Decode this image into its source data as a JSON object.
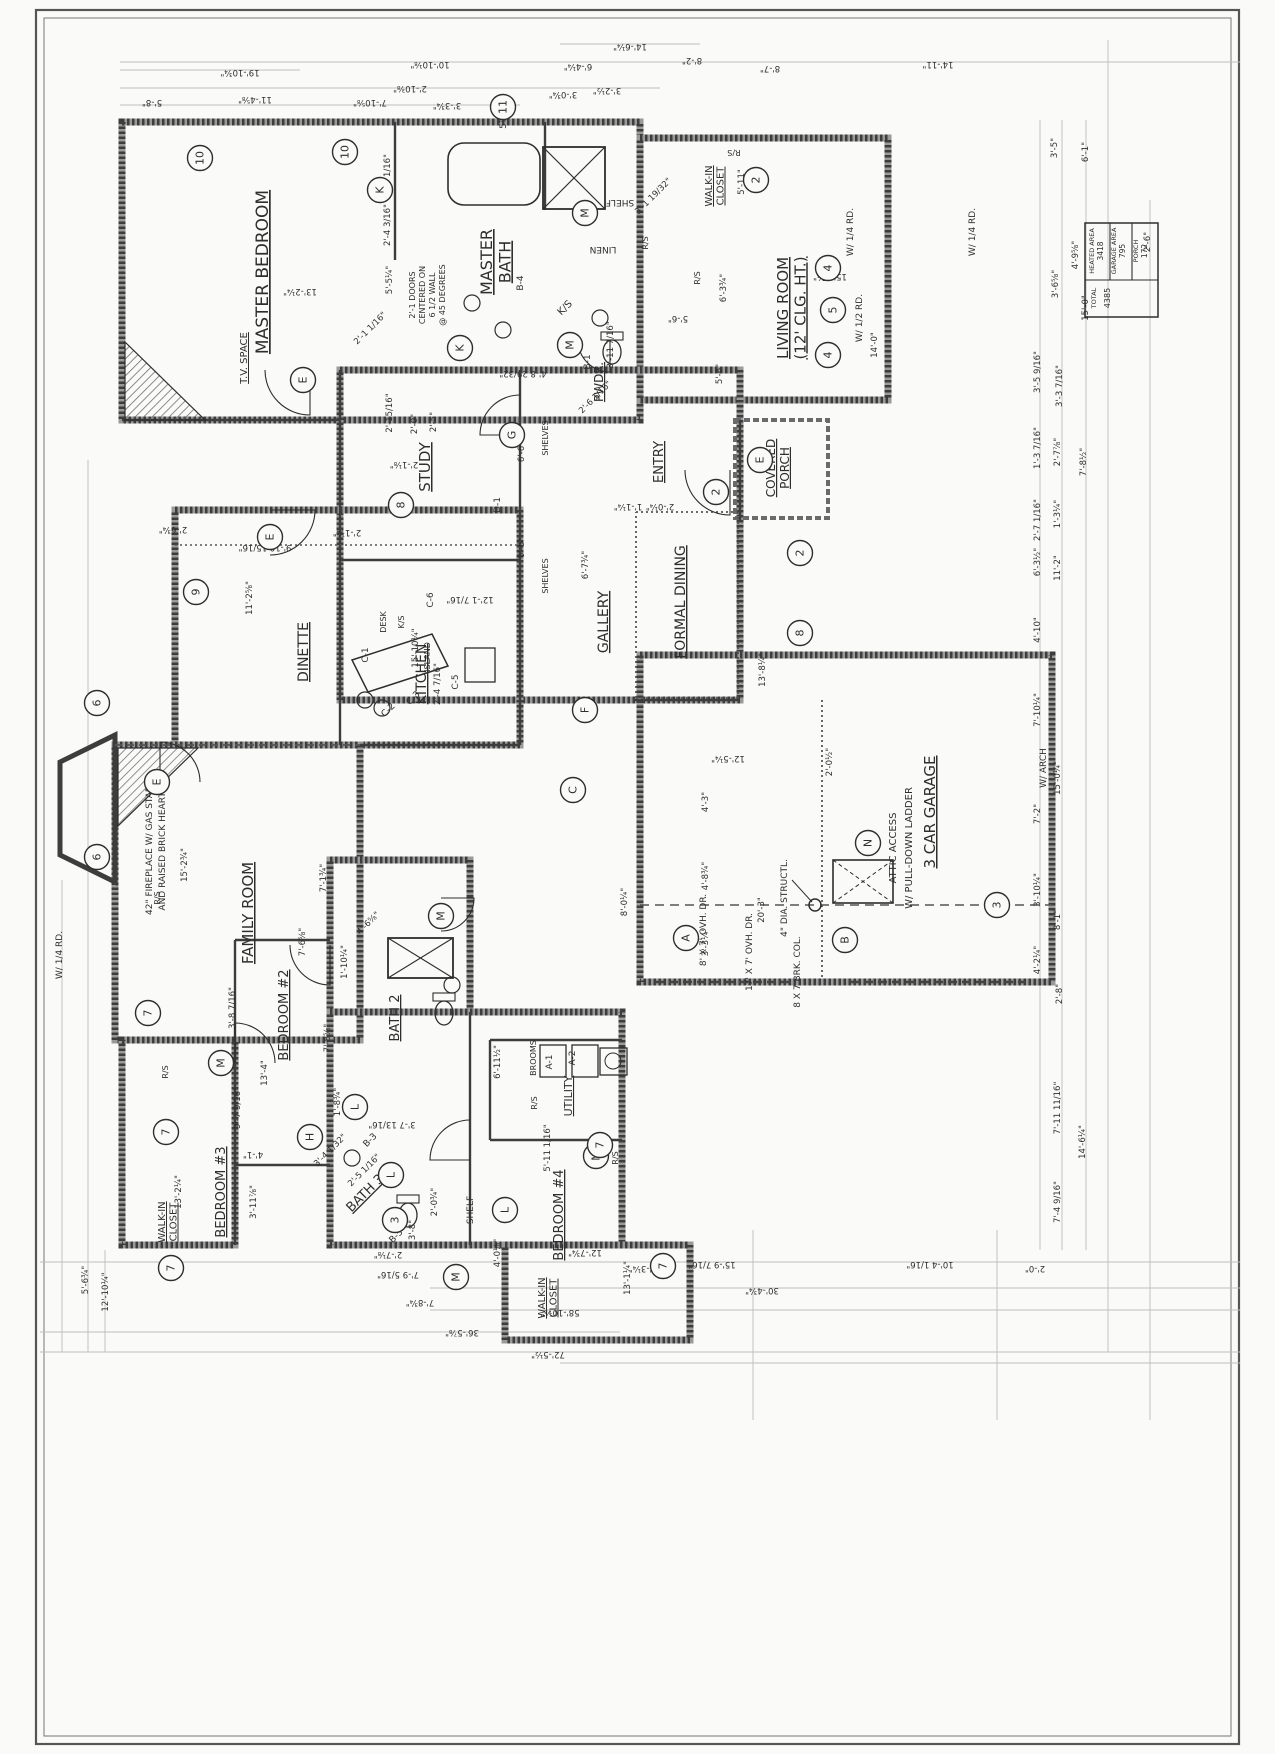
{
  "sheet": {
    "type": "residential floor plan (scanned blueprint, drawing rotated 90°)"
  },
  "area_table": {
    "cells": [
      {
        "label": "HEATED AREA",
        "value": "3418"
      },
      {
        "label": "GARAGE AREA",
        "value": "795"
      },
      {
        "label": "PORCH",
        "value": "172"
      }
    ],
    "total": {
      "label": "TOTAL",
      "value": "4385"
    }
  },
  "rooms": [
    {
      "label": [
        "MASTER BEDROOM"
      ],
      "x": 268,
      "y": 272,
      "s": 17
    },
    {
      "label": [
        "MASTER",
        "BATH"
      ],
      "x": 492,
      "y": 262,
      "s": 16
    },
    {
      "label": [
        "LIVING ROOM",
        "(12' CLG. HT.)"
      ],
      "x": 788,
      "y": 308,
      "s": 15
    },
    {
      "label": [
        "WALK-IN",
        "CLOSET"
      ],
      "x": 712,
      "y": 186,
      "s": 10
    },
    {
      "label": [
        "PWDR."
      ],
      "x": 603,
      "y": 382,
      "s": 12
    },
    {
      "label": [
        "ENTRY"
      ],
      "x": 663,
      "y": 462,
      "s": 13
    },
    {
      "label": [
        "STUDY"
      ],
      "x": 430,
      "y": 467,
      "s": 15
    },
    {
      "label": [
        "GALLERY"
      ],
      "x": 608,
      "y": 622,
      "s": 14
    },
    {
      "label": [
        "FORMAL DINING"
      ],
      "x": 685,
      "y": 602,
      "s": 14
    },
    {
      "label": [
        "DINETTE"
      ],
      "x": 308,
      "y": 652,
      "s": 14
    },
    {
      "label": [
        "KITCHEN"
      ],
      "x": 426,
      "y": 674,
      "s": 14
    },
    {
      "label": [
        "FAMILY ROOM"
      ],
      "x": 253,
      "y": 913,
      "s": 15
    },
    {
      "label": [
        "BATH 2"
      ],
      "x": 399,
      "y": 1018,
      "s": 13
    },
    {
      "label": [
        "BEDROOM #2"
      ],
      "x": 288,
      "y": 1015,
      "s": 13
    },
    {
      "label": [
        "BEDROOM #3"
      ],
      "x": 225,
      "y": 1192,
      "s": 13
    },
    {
      "label": [
        "BATH 3"
      ],
      "x": 368,
      "y": 1196,
      "s": 13,
      "r": -45
    },
    {
      "label": [
        "BEDROOM #4"
      ],
      "x": 563,
      "y": 1215,
      "s": 13
    },
    {
      "label": [
        "UTILITY"
      ],
      "x": 572,
      "y": 1096,
      "s": 11
    },
    {
      "label": [
        "3 CAR GARAGE"
      ],
      "x": 935,
      "y": 812,
      "s": 15
    },
    {
      "label": [
        "COVERED",
        "PORCH"
      ],
      "x": 775,
      "y": 468,
      "s": 12
    },
    {
      "label": [
        "WALK-IN",
        "CLOSET"
      ],
      "x": 165,
      "y": 1222,
      "s": 10
    },
    {
      "label": [
        "WALK-IN",
        "CLOSET"
      ],
      "x": 545,
      "y": 1298,
      "s": 10
    },
    {
      "label": [
        "T.V. SPACE"
      ],
      "x": 247,
      "y": 358,
      "s": 10
    }
  ],
  "markers": [
    {
      "t": "10",
      "x": 200,
      "y": 158
    },
    {
      "t": "10",
      "x": 345,
      "y": 152
    },
    {
      "t": "11",
      "x": 503,
      "y": 107
    },
    {
      "t": "K",
      "x": 380,
      "y": 190
    },
    {
      "t": "K",
      "x": 460,
      "y": 348
    },
    {
      "t": "E",
      "x": 303,
      "y": 380
    },
    {
      "t": "E",
      "x": 270,
      "y": 537
    },
    {
      "t": "E",
      "x": 760,
      "y": 460
    },
    {
      "t": "E",
      "x": 157,
      "y": 782
    },
    {
      "t": "M",
      "x": 585,
      "y": 213
    },
    {
      "t": "M",
      "x": 570,
      "y": 345
    },
    {
      "t": "M",
      "x": 441,
      "y": 916
    },
    {
      "t": "M",
      "x": 221,
      "y": 1063
    },
    {
      "t": "M",
      "x": 596,
      "y": 1156
    },
    {
      "t": "M",
      "x": 456,
      "y": 1277
    },
    {
      "t": "G",
      "x": 512,
      "y": 435
    },
    {
      "t": "8",
      "x": 401,
      "y": 505
    },
    {
      "t": "8",
      "x": 800,
      "y": 633
    },
    {
      "t": "2",
      "x": 756,
      "y": 180
    },
    {
      "t": "2",
      "x": 800,
      "y": 553
    },
    {
      "t": "2",
      "x": 716,
      "y": 492
    },
    {
      "t": "9",
      "x": 196,
      "y": 592
    },
    {
      "t": "4",
      "x": 828,
      "y": 268
    },
    {
      "t": "4",
      "x": 828,
      "y": 355
    },
    {
      "t": "5",
      "x": 833,
      "y": 310
    },
    {
      "t": "6",
      "x": 97,
      "y": 703
    },
    {
      "t": "6",
      "x": 97,
      "y": 857
    },
    {
      "t": "7",
      "x": 148,
      "y": 1013
    },
    {
      "t": "7",
      "x": 166,
      "y": 1132
    },
    {
      "t": "7",
      "x": 171,
      "y": 1268
    },
    {
      "t": "7",
      "x": 600,
      "y": 1145
    },
    {
      "t": "7",
      "x": 663,
      "y": 1266
    },
    {
      "t": "3",
      "x": 997,
      "y": 905
    },
    {
      "t": "3",
      "x": 395,
      "y": 1220
    },
    {
      "t": "N",
      "x": 868,
      "y": 843
    },
    {
      "t": "F",
      "x": 585,
      "y": 710
    },
    {
      "t": "C",
      "x": 573,
      "y": 790
    },
    {
      "t": "A",
      "x": 686,
      "y": 938
    },
    {
      "t": "B",
      "x": 845,
      "y": 940
    },
    {
      "t": "H",
      "x": 310,
      "y": 1137
    },
    {
      "t": "L",
      "x": 355,
      "y": 1107
    },
    {
      "t": "L",
      "x": 505,
      "y": 1210
    },
    {
      "t": "L",
      "x": 391,
      "y": 1175
    }
  ],
  "annotations": [
    {
      "t": "SHELF",
      "x": 620,
      "y": 200,
      "r": 180,
      "s": 9
    },
    {
      "t": "LINEN",
      "x": 603,
      "y": 247,
      "r": 180,
      "s": 9
    },
    {
      "t": "SHELF",
      "x": 473,
      "y": 1210,
      "r": -90,
      "s": 9
    },
    {
      "t": "DESK",
      "x": 386,
      "y": 622,
      "r": -90,
      "s": 8
    },
    {
      "t": "K/S",
      "x": 404,
      "y": 622,
      "r": -90,
      "s": 8
    },
    {
      "t": "K/S",
      "x": 567,
      "y": 310,
      "r": -45,
      "s": 10
    },
    {
      "t": "R/S",
      "x": 734,
      "y": 150,
      "r": 180,
      "s": 8
    },
    {
      "t": "R/S",
      "x": 700,
      "y": 278,
      "r": -90,
      "s": 8
    },
    {
      "t": "R/S",
      "x": 648,
      "y": 243,
      "r": -90,
      "s": 8
    },
    {
      "t": "R/S",
      "x": 160,
      "y": 898,
      "r": -90,
      "s": 8
    },
    {
      "t": "R/S",
      "x": 168,
      "y": 1072,
      "r": -90,
      "s": 8
    },
    {
      "t": "R/S",
      "x": 537,
      "y": 1103,
      "r": -90,
      "s": 8
    },
    {
      "t": "R/S",
      "x": 618,
      "y": 1158,
      "r": -90,
      "s": 8
    },
    {
      "t": "BROOMS",
      "x": 536,
      "y": 1058,
      "r": -90,
      "s": 8
    },
    {
      "t": "ATTIC ACCESS",
      "x": 896,
      "y": 848,
      "r": -90,
      "s": 10
    },
    {
      "t": "W/ PULL-DOWN LADDER",
      "x": 912,
      "y": 848,
      "r": -90,
      "s": 10
    },
    {
      "t": "42\" FIREPLACE W/ GAS START",
      "x": 152,
      "y": 848,
      "r": -90,
      "s": 9
    },
    {
      "t": "AND RAISED BRICK HEARTH",
      "x": 165,
      "y": 848,
      "r": -90,
      "s": 9
    },
    {
      "t": "4\" DIA. STRUCTL.",
      "x": 787,
      "y": 898,
      "r": -90,
      "s": 9
    },
    {
      "t": "8 X 7 BRK. COL.",
      "x": 800,
      "y": 972,
      "r": -90,
      "s": 9
    },
    {
      "t": "8' X 7' OVH. DR.",
      "x": 706,
      "y": 930,
      "r": -90,
      "s": 9
    },
    {
      "t": "17' X 7' OVH. DR.",
      "x": 752,
      "y": 952,
      "r": -90,
      "s": 9
    },
    {
      "t": "W/ 1/2 RD.",
      "x": 862,
      "y": 318,
      "r": -90,
      "s": 9
    },
    {
      "t": "W/ 1/4 RD.",
      "x": 853,
      "y": 232,
      "r": -90,
      "s": 9
    },
    {
      "t": "W/ 1/4 RD.",
      "x": 975,
      "y": 232,
      "r": -90,
      "s": 9
    },
    {
      "t": "W/ 1/4 RD.",
      "x": 62,
      "y": 955,
      "r": -90,
      "s": 9
    },
    {
      "t": "W/ ARCH",
      "x": 1046,
      "y": 768,
      "r": -90,
      "s": 9
    },
    {
      "t": "2'-1 DOORS",
      "x": 415,
      "y": 295,
      "r": -90,
      "s": 8
    },
    {
      "t": "CENTERED ON",
      "x": 425,
      "y": 295,
      "r": -90,
      "s": 8
    },
    {
      "t": "6 1/2 WALL",
      "x": 435,
      "y": 295,
      "r": -90,
      "s": 8
    },
    {
      "t": "@ 45 DEGREES",
      "x": 445,
      "y": 295,
      "r": -90,
      "s": 8
    },
    {
      "t": "ISLAND",
      "x": 430,
      "y": 657,
      "r": -90,
      "s": 8
    },
    {
      "t": "SHELVES",
      "x": 548,
      "y": 438,
      "r": -90,
      "s": 8
    },
    {
      "t": "SHELVES",
      "x": 548,
      "y": 576,
      "r": -90,
      "s": 8
    },
    {
      "t": "B-1",
      "x": 590,
      "y": 362,
      "r": -90,
      "s": 9
    },
    {
      "t": "B-3",
      "x": 372,
      "y": 1142,
      "r": -45,
      "s": 9
    },
    {
      "t": "B-4",
      "x": 523,
      "y": 283,
      "r": -90,
      "s": 9
    },
    {
      "t": "B-5",
      "x": 398,
      "y": 1238,
      "r": -45,
      "s": 9
    },
    {
      "t": "D-1",
      "x": 500,
      "y": 505,
      "r": -90,
      "s": 9
    },
    {
      "t": "A-1",
      "x": 552,
      "y": 1062,
      "r": -90,
      "s": 9
    },
    {
      "t": "A-2",
      "x": 575,
      "y": 1058,
      "r": -90,
      "s": 9
    },
    {
      "t": "C-1",
      "x": 368,
      "y": 655,
      "r": -90,
      "s": 9
    },
    {
      "t": "C-2",
      "x": 390,
      "y": 712,
      "r": -45,
      "s": 9
    },
    {
      "t": "C-3",
      "x": 415,
      "y": 700,
      "r": -45,
      "s": 9
    },
    {
      "t": "C-5",
      "x": 458,
      "y": 682,
      "r": -90,
      "s": 9
    },
    {
      "t": "C-6",
      "x": 433,
      "y": 600,
      "r": -90,
      "s": 9
    }
  ],
  "dims": [
    {
      "t": "5'-8\"",
      "x": 152,
      "y": 100,
      "r": 180
    },
    {
      "t": "19'-10¾\"",
      "x": 240,
      "y": 70,
      "r": 180
    },
    {
      "t": "11'-4⅝\"",
      "x": 255,
      "y": 97,
      "r": 180
    },
    {
      "t": "7'-10⅝\"",
      "x": 370,
      "y": 100,
      "r": 180
    },
    {
      "t": "10'-10⅛\"",
      "x": 430,
      "y": 62,
      "r": 180
    },
    {
      "t": "2'-10⅜\"",
      "x": 410,
      "y": 86,
      "r": 180
    },
    {
      "t": "3'-3¾\"",
      "x": 447,
      "y": 103,
      "r": 180
    },
    {
      "t": "5⅞\"",
      "x": 506,
      "y": 120,
      "r": -90
    },
    {
      "t": "3'-0¾\"",
      "x": 563,
      "y": 92,
      "r": 180
    },
    {
      "t": "3'-2½\"",
      "x": 607,
      "y": 88,
      "r": 180
    },
    {
      "t": "6'-4¼\"",
      "x": 578,
      "y": 64,
      "r": 180
    },
    {
      "t": "14'-6¼\"",
      "x": 630,
      "y": 44,
      "r": 180
    },
    {
      "t": "8'-2\"",
      "x": 692,
      "y": 58,
      "r": 180
    },
    {
      "t": "8'-7\"",
      "x": 770,
      "y": 66,
      "r": 180
    },
    {
      "t": "14'-11\"",
      "x": 938,
      "y": 62,
      "r": 180
    },
    {
      "t": "3'-5\"",
      "x": 1057,
      "y": 148,
      "r": -90
    },
    {
      "t": "6'-1\"",
      "x": 1088,
      "y": 152,
      "r": -90
    },
    {
      "t": "2'-6\"",
      "x": 1150,
      "y": 242,
      "r": -90
    },
    {
      "t": "4'-9⅝\"",
      "x": 1078,
      "y": 255,
      "r": -90
    },
    {
      "t": "3'-6⅝\"",
      "x": 1058,
      "y": 284,
      "r": -90
    },
    {
      "t": "15'-0\"",
      "x": 1088,
      "y": 308,
      "r": -90
    },
    {
      "t": "3'-5 9/16\"",
      "x": 1040,
      "y": 372,
      "r": -90
    },
    {
      "t": "3'-3 7/16\"",
      "x": 1062,
      "y": 386,
      "r": -90
    },
    {
      "t": "1'-3 7/16\"",
      "x": 1040,
      "y": 448,
      "r": -90
    },
    {
      "t": "2'-7⅞\"",
      "x": 1060,
      "y": 452,
      "r": -90
    },
    {
      "t": "7'-8½\"",
      "x": 1086,
      "y": 462,
      "r": -90
    },
    {
      "t": "2'-7 1/16\"",
      "x": 1040,
      "y": 520,
      "r": -90
    },
    {
      "t": "1'-3¼\"",
      "x": 1060,
      "y": 514,
      "r": -90
    },
    {
      "t": "6'-3½\"",
      "x": 1040,
      "y": 562,
      "r": -90
    },
    {
      "t": "11'-2\"",
      "x": 1060,
      "y": 568,
      "r": -90
    },
    {
      "t": "4'-10\"",
      "x": 1040,
      "y": 630,
      "r": -90
    },
    {
      "t": "7'-10¼\"",
      "x": 1040,
      "y": 710,
      "r": -90
    },
    {
      "t": "15'-0¼\"",
      "x": 1060,
      "y": 778,
      "r": -90
    },
    {
      "t": "7'-2\"",
      "x": 1040,
      "y": 814,
      "r": -90
    },
    {
      "t": "3'-10¼\"",
      "x": 1040,
      "y": 890,
      "r": -90
    },
    {
      "t": "8'-1\"",
      "x": 1060,
      "y": 920,
      "r": -90
    },
    {
      "t": "4'-2¼\"",
      "x": 1040,
      "y": 960,
      "r": -90
    },
    {
      "t": "2'-8\"",
      "x": 1062,
      "y": 994,
      "r": -90
    },
    {
      "t": "7'-11 11/16\"",
      "x": 1060,
      "y": 1108,
      "r": -90
    },
    {
      "t": "14'-6¼\"",
      "x": 1085,
      "y": 1142,
      "r": -90
    },
    {
      "t": "7'-4 9/16\"",
      "x": 1060,
      "y": 1202,
      "r": -90
    },
    {
      "t": "4'-3¼\"",
      "x": 643,
      "y": 1266,
      "r": 180
    },
    {
      "t": "15'-9 7/16\"",
      "x": 712,
      "y": 1262,
      "r": 180
    },
    {
      "t": "10'-4 1/16\"",
      "x": 930,
      "y": 1262,
      "r": 180
    },
    {
      "t": "2'-0\"",
      "x": 1035,
      "y": 1266,
      "r": 180
    },
    {
      "t": "30'-4¾\"",
      "x": 762,
      "y": 1288,
      "r": 180
    },
    {
      "t": "58'-10⅝\"",
      "x": 560,
      "y": 1310,
      "r": 180
    },
    {
      "t": "36'-5⅞\"",
      "x": 462,
      "y": 1330,
      "r": 180
    },
    {
      "t": "72'-5½\"",
      "x": 548,
      "y": 1352,
      "r": 180
    },
    {
      "t": "12'-10¼\"",
      "x": 108,
      "y": 1292,
      "r": -90
    },
    {
      "t": "5'-6¾\"",
      "x": 88,
      "y": 1280,
      "r": -90
    },
    {
      "t": "7'-8¾\"",
      "x": 420,
      "y": 1300,
      "r": 180
    },
    {
      "t": "7'-9 5/16\"",
      "x": 398,
      "y": 1272,
      "r": 180
    },
    {
      "t": "2'-7⅛\"",
      "x": 388,
      "y": 1252,
      "r": 180
    },
    {
      "t": "13'-1¼\"",
      "x": 630,
      "y": 1278,
      "r": -90
    },
    {
      "t": "12'-7¾\"",
      "x": 585,
      "y": 1250,
      "r": 180
    },
    {
      "t": "4'-0⅛\"",
      "x": 500,
      "y": 1253,
      "r": -90
    },
    {
      "t": "13'-2¼\"",
      "x": 300,
      "y": 289,
      "r": 180
    },
    {
      "t": "15'-1¾\"",
      "x": 830,
      "y": 274,
      "r": 180
    },
    {
      "t": "14'-0\"",
      "x": 877,
      "y": 345,
      "r": -90
    },
    {
      "t": "13'-8¼\"",
      "x": 765,
      "y": 670,
      "r": -90
    },
    {
      "t": "12'-1 7/16\"",
      "x": 470,
      "y": 597,
      "r": 180
    },
    {
      "t": "6'-6\"",
      "x": 524,
      "y": 452,
      "r": -90
    },
    {
      "t": "6'-6\"",
      "x": 524,
      "y": 548,
      "r": -90
    },
    {
      "t": "6'-7¾\"",
      "x": 588,
      "y": 565,
      "r": -90
    },
    {
      "t": "2'-15/16\"",
      "x": 392,
      "y": 413,
      "r": -90
    },
    {
      "t": "2'-0\"",
      "x": 417,
      "y": 424,
      "r": -90
    },
    {
      "t": "2'-5\"",
      "x": 436,
      "y": 422,
      "r": -90
    },
    {
      "t": "2'-1⅛\"",
      "x": 404,
      "y": 462,
      "r": 180
    },
    {
      "t": "4'-8 29/32\"",
      "x": 523,
      "y": 371,
      "r": 180
    },
    {
      "t": "2'-6 1/16\"",
      "x": 597,
      "y": 399,
      "r": -45
    },
    {
      "t": "3'-11 7/16\"",
      "x": 613,
      "y": 345,
      "r": -90
    },
    {
      "t": "3'-1 19/32\"",
      "x": 655,
      "y": 198,
      "r": -45
    },
    {
      "t": "5'-11\"",
      "x": 744,
      "y": 182,
      "r": -90
    },
    {
      "t": "6'-3¾\"",
      "x": 726,
      "y": 288,
      "r": -90
    },
    {
      "t": "5'-6\"",
      "x": 678,
      "y": 316,
      "r": 180
    },
    {
      "t": "5'-6\"",
      "x": 722,
      "y": 374,
      "r": -90
    },
    {
      "t": "2'-0¼\"",
      "x": 660,
      "y": 504,
      "r": 180
    },
    {
      "t": "1'-1¼\"",
      "x": 628,
      "y": 504,
      "r": 180
    },
    {
      "t": "9'-10 15/16\"",
      "x": 265,
      "y": 545,
      "r": 180
    },
    {
      "t": "2'-1¼\"",
      "x": 347,
      "y": 530,
      "r": 180
    },
    {
      "t": "2'-6¾\"",
      "x": 173,
      "y": 527,
      "r": 180
    },
    {
      "t": "11'-2⅝\"",
      "x": 252,
      "y": 598,
      "r": -90
    },
    {
      "t": "15'-10¼\"",
      "x": 418,
      "y": 648,
      "r": -90
    },
    {
      "t": "2'-4 7/16\"",
      "x": 440,
      "y": 684,
      "r": -90
    },
    {
      "t": "12'-5¼\"",
      "x": 728,
      "y": 756,
      "r": 180
    },
    {
      "t": "2'-0½\"",
      "x": 832,
      "y": 762,
      "r": -90
    },
    {
      "t": "4'-3\"",
      "x": 708,
      "y": 802,
      "r": -90
    },
    {
      "t": "4'-8¾\"",
      "x": 708,
      "y": 876,
      "r": -90
    },
    {
      "t": "3'-3¼\"",
      "x": 708,
      "y": 942,
      "r": -90
    },
    {
      "t": "20'-3\"",
      "x": 764,
      "y": 910,
      "r": -90
    },
    {
      "t": "8'-0¼\"",
      "x": 627,
      "y": 902,
      "r": -90
    },
    {
      "t": "15'-2¾\"",
      "x": 187,
      "y": 865,
      "r": -90
    },
    {
      "t": "7'-1¾\"",
      "x": 326,
      "y": 878,
      "r": -90
    },
    {
      "t": "4'-6⅝\"",
      "x": 370,
      "y": 925,
      "r": -45
    },
    {
      "t": "1'-10¼\"",
      "x": 347,
      "y": 962,
      "r": -90
    },
    {
      "t": "7'-6⅝\"",
      "x": 305,
      "y": 942,
      "r": -90
    },
    {
      "t": "3'-8 7/16\"",
      "x": 235,
      "y": 1008,
      "r": -90
    },
    {
      "t": "7'-8⅝\"",
      "x": 330,
      "y": 1038,
      "r": -90
    },
    {
      "t": "13'-4\"",
      "x": 267,
      "y": 1073,
      "r": -90
    },
    {
      "t": "9'-7 9/16\"",
      "x": 240,
      "y": 1108,
      "r": -90
    },
    {
      "t": "1'-8¾\"",
      "x": 340,
      "y": 1102,
      "r": -90
    },
    {
      "t": "3'-4 1/32\"",
      "x": 332,
      "y": 1152,
      "r": -45
    },
    {
      "t": "2'-5 1/16\"",
      "x": 366,
      "y": 1172,
      "r": -45
    },
    {
      "t": "4'-1\"",
      "x": 253,
      "y": 1152,
      "r": 180
    },
    {
      "t": "3'-11⅞\"",
      "x": 256,
      "y": 1202,
      "r": -90
    },
    {
      "t": "13'-2¼\"",
      "x": 181,
      "y": 1192,
      "r": -90
    },
    {
      "t": "3'-7 13/16\"",
      "x": 392,
      "y": 1122,
      "r": 180
    },
    {
      "t": "6'-11½\"",
      "x": 500,
      "y": 1062,
      "r": -90
    },
    {
      "t": "5'-11 1/16\"",
      "x": 550,
      "y": 1148,
      "r": -90
    },
    {
      "t": "3'-8\"",
      "x": 415,
      "y": 1230,
      "r": -90
    },
    {
      "t": "2'-0¾\"",
      "x": 437,
      "y": 1202,
      "r": -90
    },
    {
      "t": "2'-4 3/16\"",
      "x": 390,
      "y": 225,
      "r": -90
    },
    {
      "t": "5'-5¼\"",
      "x": 392,
      "y": 280,
      "r": -90
    },
    {
      "t": "5'-9 1/16\"",
      "x": 390,
      "y": 175,
      "r": -90
    },
    {
      "t": "2'-1 1/16\"",
      "x": 372,
      "y": 330,
      "r": -45
    }
  ]
}
